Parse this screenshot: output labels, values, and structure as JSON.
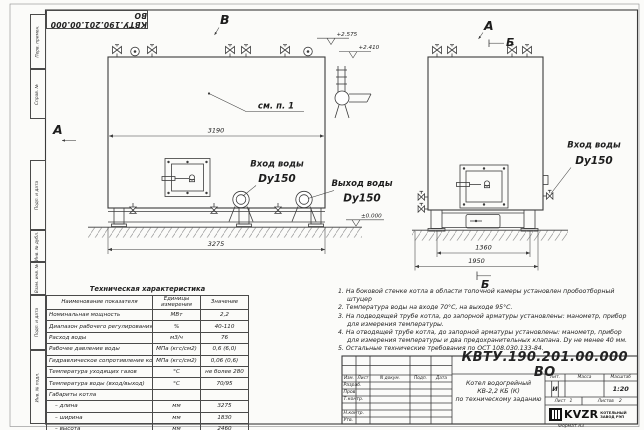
{
  "sheet": {
    "stamp": "КВТУ.190.201.00.000 ВО",
    "margin_labels": [
      "Перв. примен.",
      "Справ. №",
      "Подп. и дата",
      "Инв. № дубл.",
      "Взам. инв. №",
      "Подп. и дата",
      "Инв. № подл."
    ]
  },
  "front_view": {
    "view_letter_a": "А",
    "view_letter_v": "В",
    "callout": "см. п. 1",
    "dim_3190": "3190",
    "dim_3275": "3275",
    "elev_top": "+2.575",
    "elev_mid": "+2.410",
    "elev_ground": "±0.000",
    "inlet_label": "Вход воды",
    "inlet_dn": "Dy150",
    "outlet_label": "Выход воды",
    "outlet_dn": "Dy150"
  },
  "side_view": {
    "view_letter_a": "А",
    "section_letter_top": "Б",
    "section_letter_bottom": "Б",
    "dim_1360": "1360",
    "dim_1950": "1950",
    "inlet_label": "Вход воды",
    "inlet_dn": "Dy150"
  },
  "spec_table": {
    "title": "Техническая характеристика",
    "headers": [
      "Наименование показателя",
      "Единицы измерения",
      "Значение"
    ],
    "rows": [
      [
        "Номинальная мощность",
        "МВт",
        "2,2"
      ],
      [
        "Диапазон рабочего регулирования",
        "%",
        "40-110"
      ],
      [
        "Расход воды",
        "м3/ч",
        "76"
      ],
      [
        "Рабочее давление воды",
        "МПа (кгс/см2)",
        "0,6 (6,0)"
      ],
      [
        "Гидравлическое сопротивление котла",
        "МПа (кгс/см2)",
        "0,06 (0,6)"
      ],
      [
        "Температура уходящих газов",
        "°С",
        "не более 280"
      ],
      [
        "Температура воды (вход/выход)",
        "°С",
        "70/95"
      ],
      [
        "Габариты котла",
        "",
        ""
      ],
      [
        "– длина",
        "мм",
        "3275"
      ],
      [
        "– ширина",
        "мм",
        "1830"
      ],
      [
        "– высота",
        "мм",
        "2460"
      ]
    ]
  },
  "notes": [
    "1.  На боковой стенке котла в области топочной камеры установлен пробоотборный штуцер",
    "2.  Температура воды на входе 70°С, на выходе 95°С.",
    "3.  На подводящей трубе котла, до запорной арматуры установлены: манометр, прибор для измерения температуры.",
    "4.  На отводящей трубе котла, до запорной арматуры установлены: манометр, прибор для измерения температуры и два предохранительных клапана. Dу не менее 40 мм.",
    "5.  Остальные технические требования по ОСТ 108.030.133-84."
  ],
  "titleblock": {
    "doc_number": "КВТУ.190.201.00.000  ВО",
    "name_line1": "Котел водогрейный",
    "name_line2": "КВ-2,2 КБ (К)",
    "name_line3": "по техническому заданию",
    "col_izm": "Изм.",
    "col_list": "Лист",
    "col_doc": "N докум.",
    "col_podp": "Подп.",
    "col_data": "Дата",
    "row_razrab": "Разраб.",
    "row_prov": "Пров.",
    "row_tkontr": "Т.контр.",
    "row_nkontr": "Н.контр.",
    "row_utv": "Утв.",
    "lit_header": "Лит.",
    "mass_header": "Масса",
    "scale_header": "Масштаб",
    "lit": "И",
    "scale": "1:20",
    "sheet_header": "Лист",
    "sheet_num": "1",
    "sheets_header": "Листов",
    "sheets_num": "2",
    "brand": "KVZR",
    "brand_line1": "КОТЕЛЬНЫЙ",
    "brand_line2": "ЗАВОД РЭП",
    "format": "Формат  А3"
  }
}
